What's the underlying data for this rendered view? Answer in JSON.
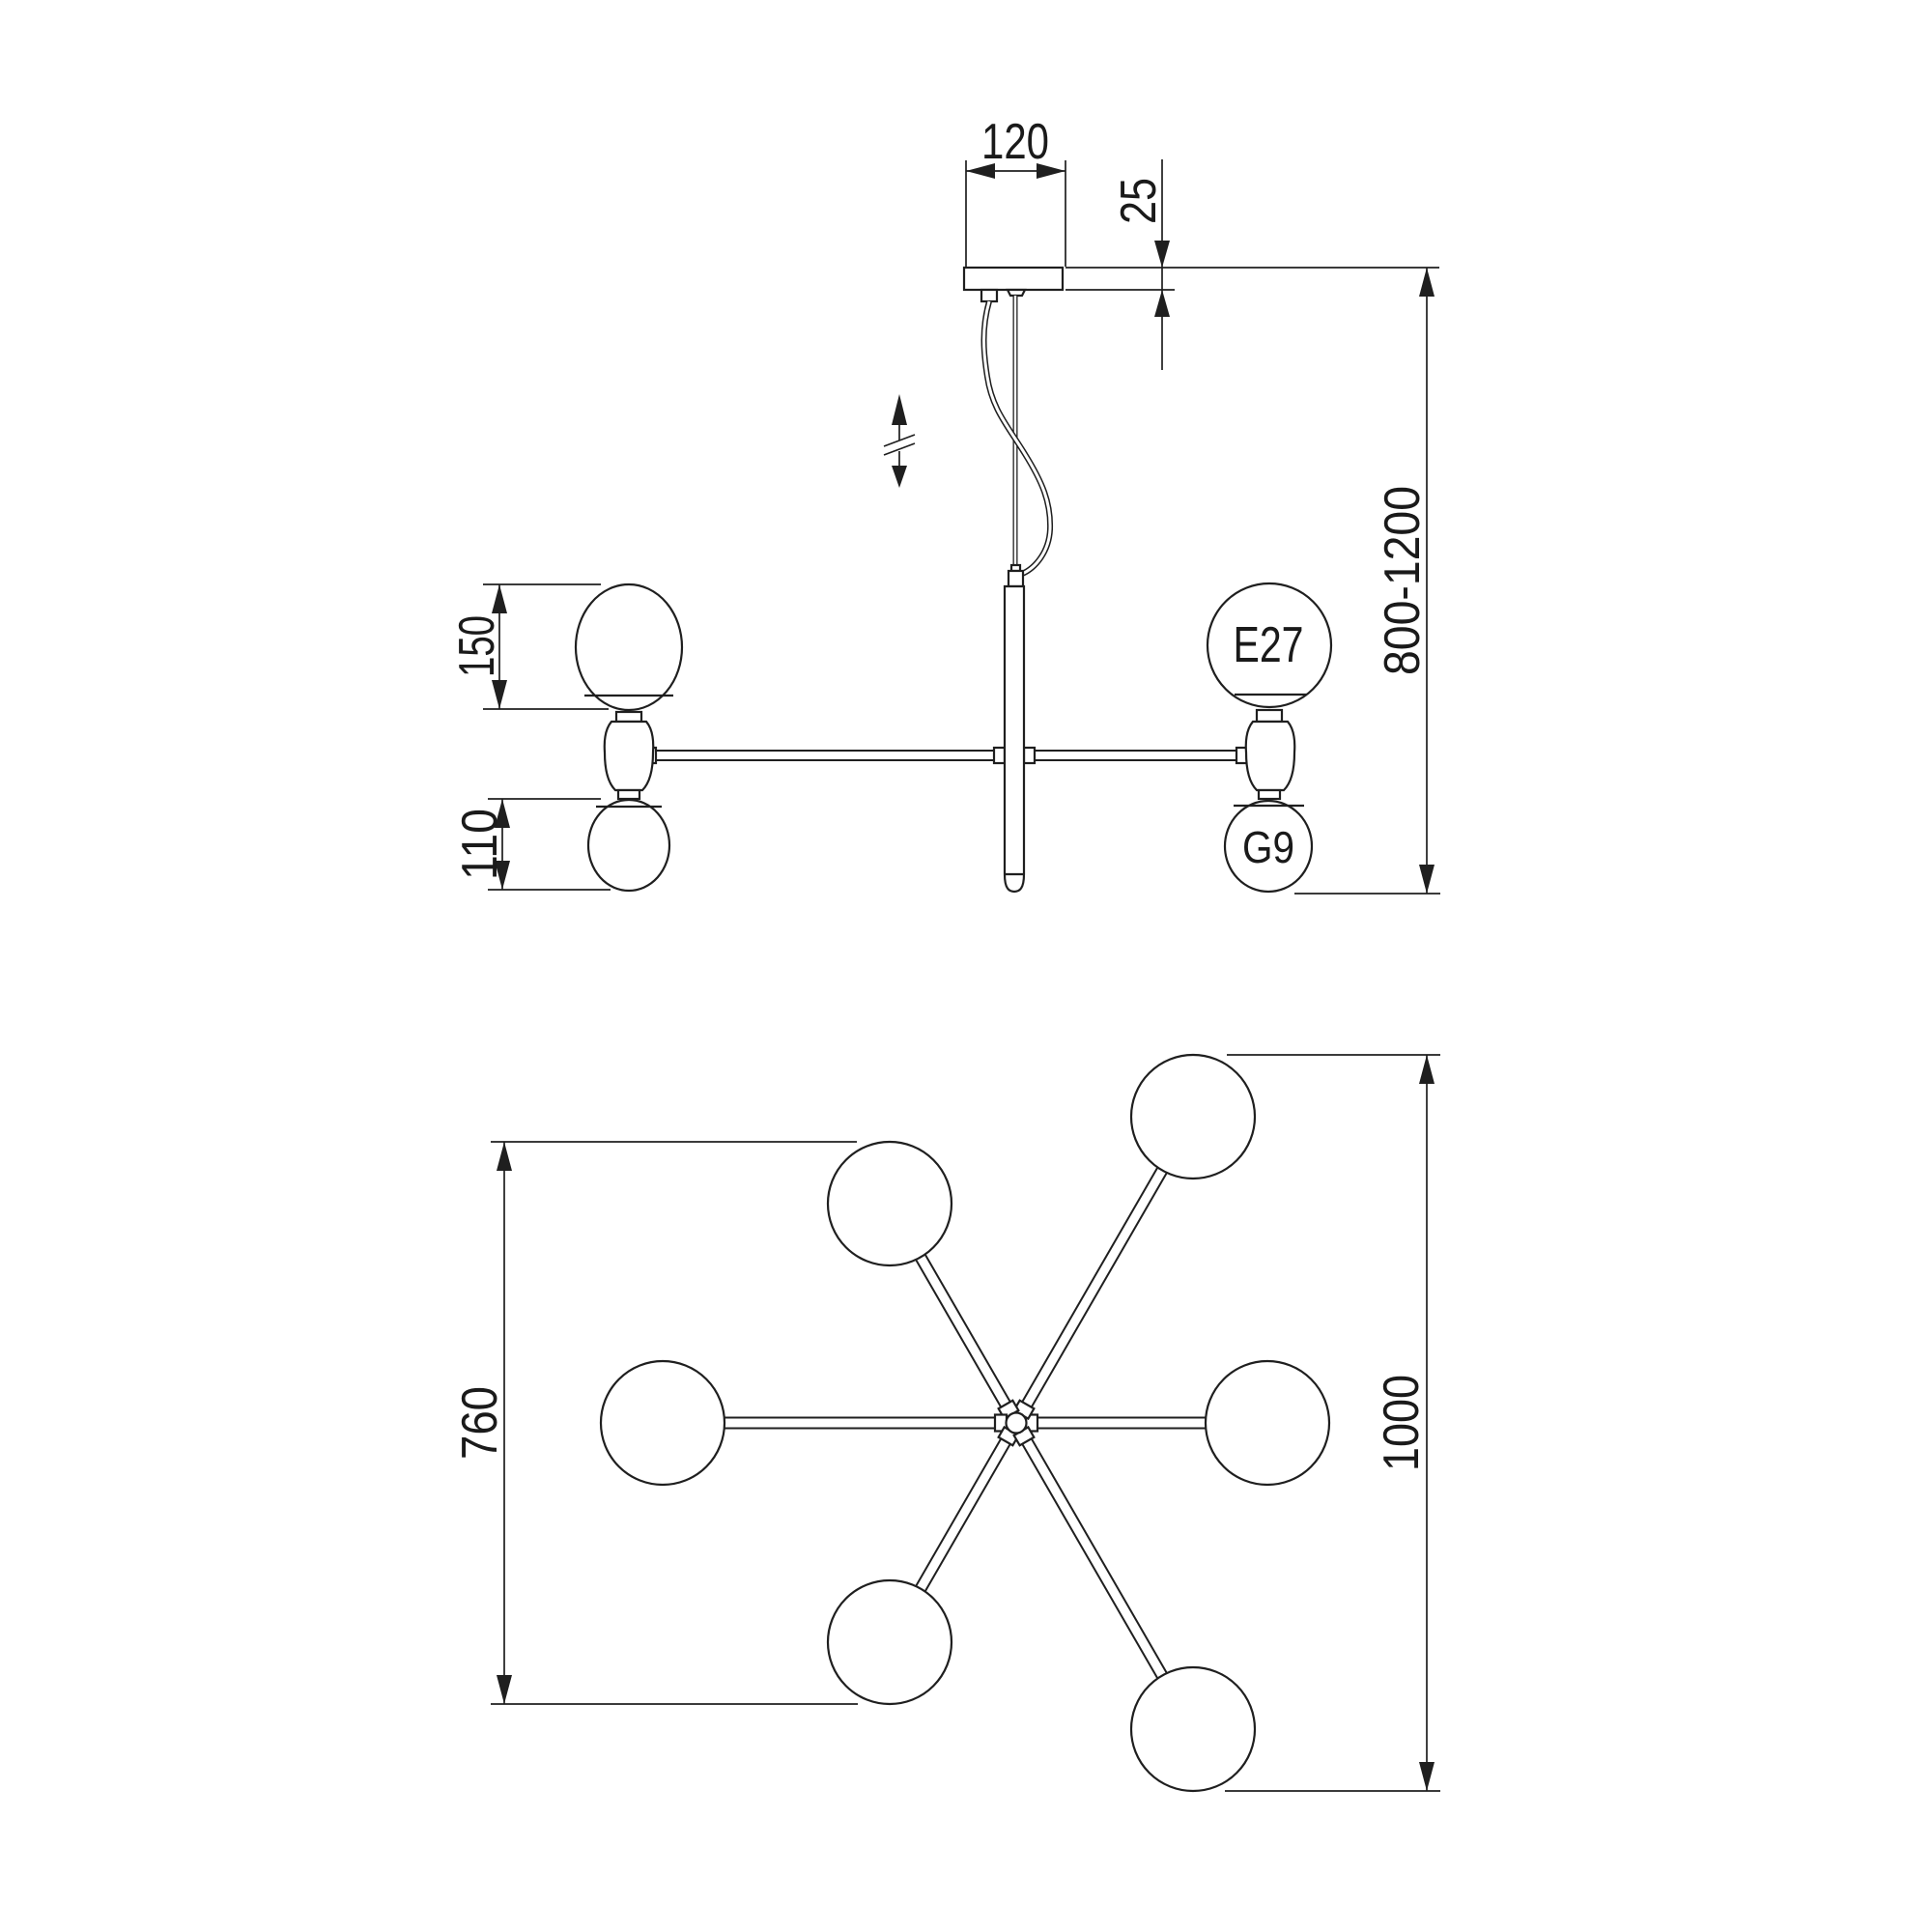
{
  "drawing_type": "pendant chandelier dimensional drawing",
  "side_view": {
    "canopy_width_mm": "120",
    "canopy_thickness_mm": "25",
    "suspension_height_range_mm": "800-1200",
    "large_globe_diameter_mm": "150",
    "small_globe_diameter_mm": "110",
    "large_bulb_socket": "E27",
    "small_bulb_socket": "G9"
  },
  "plan_view": {
    "inner_arm_span_mm": "760",
    "overall_diameter_mm": "1000"
  },
  "colors": {
    "line": "#1f1f1f",
    "background": "#ffffff"
  }
}
